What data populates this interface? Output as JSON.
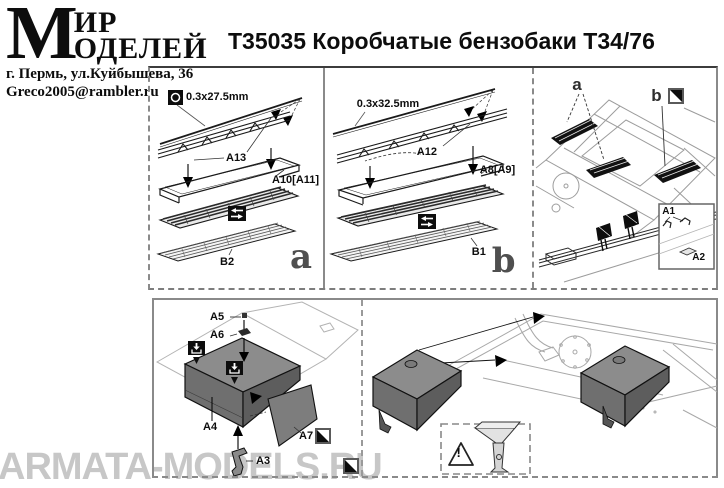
{
  "brand": {
    "initial": "М",
    "word_top": "ИР",
    "word_bottom": "ОДЕЛЕЙ",
    "address": "г. Пермь, ул.Куйбышева, 36",
    "email": "Greco2005@rambler.ru"
  },
  "title": "Т35035 Коробчатые бензобаки Т34/76",
  "watermark": "ARMATA-MODELS.RU",
  "panel_a": {
    "letter": "a",
    "wire": "0.3x27.5mm",
    "rod": "A13",
    "frame": "A10[A11]",
    "grille": "B2"
  },
  "panel_b": {
    "letter": "b",
    "wire": "0.3x32.5mm",
    "rod": "A12",
    "frame": "A8[A9]",
    "grille": "B1"
  },
  "panel_deck": {
    "marker_a": "a",
    "marker_b": "b",
    "inset_part_1": "A1",
    "inset_part_2": "A2"
  },
  "panel_assembly": {
    "pin": "A5",
    "clamp": "A6",
    "tank": "A4",
    "side_panel": "A7",
    "bracket": "A3"
  },
  "panel_mounting": {
    "warning": "!"
  },
  "colors": {
    "ink": "#111111",
    "border": "#808080",
    "tank": "#6f6f6f",
    "watermark": "#c7c7c7"
  }
}
